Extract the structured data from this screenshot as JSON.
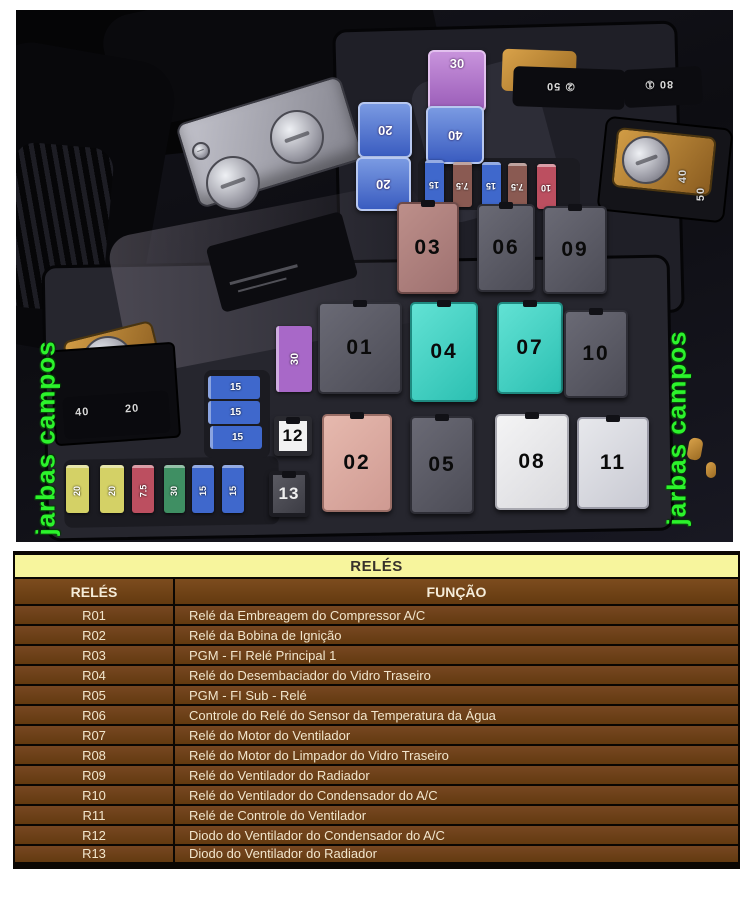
{
  "photo": {
    "watermark_left": "jarbas campos",
    "watermark_right": "jarbas campos",
    "relay_labels": {
      "r01": "01",
      "r02": "02",
      "r03": "03",
      "r04": "04",
      "r05": "05",
      "r06": "06",
      "r07": "07",
      "r08": "08",
      "r09": "09",
      "r10": "10",
      "r11": "11",
      "r12": "12",
      "r13": "13"
    },
    "fuses": {
      "jcase_purple_30": "30",
      "jcase_blue_20_upper": "20",
      "jcase_blue_40": "40",
      "jcase_blue_20_lower": "20",
      "mini_top_row": [
        "15",
        "7.5",
        "15",
        "7.5",
        "10"
      ],
      "stack_15": [
        "15",
        "15",
        "15"
      ],
      "mini_bottom_row": [
        "20",
        "20",
        "7.5",
        "30",
        "15",
        "15"
      ],
      "purple_vertical_30": "30",
      "main_fuse_marks": [
        "40",
        "20"
      ],
      "block_mark_a": "② 50",
      "block_mark_b": "80 ①",
      "right_terminal_marks": [
        "40",
        "50"
      ]
    }
  },
  "table": {
    "title": "RELÉS",
    "columns": [
      "RELÉS",
      "FUNÇÃO"
    ],
    "rows": [
      {
        "relay": "R01",
        "funcao": "Relé da Embreagem do Compressor A/C"
      },
      {
        "relay": "R02",
        "funcao": "Relé da Bobina de Ignição"
      },
      {
        "relay": "R03",
        "funcao": "PGM - FI Relé Principal 1"
      },
      {
        "relay": "R04",
        "funcao": "Relé do Desembaciador do Vidro Traseiro"
      },
      {
        "relay": "R05",
        "funcao": "PGM - FI Sub - Relé"
      },
      {
        "relay": "R06",
        "funcao": "Controle do Relé do Sensor da Temperatura da Água"
      },
      {
        "relay": "R07",
        "funcao": "Relé do Motor do Ventilador"
      },
      {
        "relay": "R08",
        "funcao": "Relé do Motor do Limpador do Vidro Traseiro"
      },
      {
        "relay": "R09",
        "funcao": "Relé do Ventilador do Radiador"
      },
      {
        "relay": "R10",
        "funcao": "Relé do Ventilador do Condensador do A/C"
      },
      {
        "relay": "R11",
        "funcao": "Relé de Controle do Ventilador"
      },
      {
        "relay": "R12",
        "funcao": "Diodo do Ventilador do Condensador do A/C"
      },
      {
        "relay": "R13",
        "funcao": "Diodo do Ventilador do Radiador"
      }
    ]
  },
  "colors": {
    "table_header_yellow": "#f7f59d",
    "table_brown": "#6e4118",
    "watermark_green": "#2cf32c",
    "relay_teal": "#3fd4c4",
    "relay_rose": "#ad7f7f"
  }
}
